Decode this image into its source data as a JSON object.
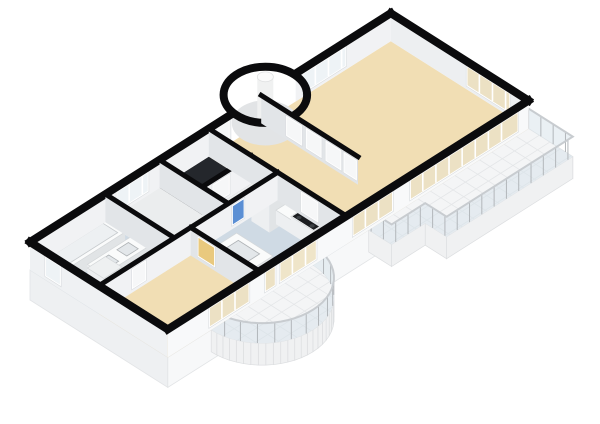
{
  "scene": {
    "canvas": {
      "width": 600,
      "height": 424,
      "background": "#ffffff"
    },
    "projection": {
      "ox": 30,
      "oy": 270,
      "k": 0.82,
      "m": 0.52
    },
    "wall_height": 28,
    "plinth_depth": 30,
    "railing_height": 20,
    "palette": {
      "wall_cut": "#0b0b0d",
      "face_se": "#f1f2f4",
      "face_sw": "#e2e5e8",
      "plinth_se": "#f7f8f9",
      "plinth_sw": "#eef0f2",
      "plinth_edge": "#e2e4e6",
      "terrace": "#f4f5f6",
      "terrace_line": "#e4e6e8",
      "slab": "#f0f1f2",
      "slab_edge": "#dcdee0",
      "railing_glass": "rgba(213,225,233,0.5)",
      "railing_post": "#b2b6ba",
      "railing_top": "#c8ccd0",
      "fix_top": "#fafbfb",
      "fix_se": "#e1e4e6",
      "fix_sw": "#edeff1",
      "turret_floor": "#e2e4e6",
      "column_body": "#f0f1f1",
      "column_top": "#fbfbfb",
      "stove_top": "#1b1d20",
      "burner": "#3c4044",
      "sink_fill": "#e3e7ea",
      "sink_edge": "#aeb2b5",
      "tub_inner": "#edf0f2",
      "tub_edge": "#c6cacd",
      "floors": {
        "wood": "#f1deb4",
        "tile": "#cfdae4",
        "plain": "#ebedee",
        "dark": "#24272c"
      },
      "features": {
        "window": "#eef3f6",
        "window-tan": "#efe5c9",
        "glass-tan": "#ece1c4",
        "door-white": "#f6f7f8",
        "door-blue": "#5b8fd4",
        "door-yellow": "#e9c97e"
      }
    },
    "plinth": [
      {
        "dir": "v",
        "x": 0,
        "y1": 0,
        "y2": 168
      },
      {
        "dir": "u",
        "y": 168,
        "x1": 0,
        "x2": 440
      }
    ],
    "terr": {
      "poly": [
        [
          245,
          168
        ],
        [
          440,
          168
        ],
        [
          440,
          222
        ],
        [
          286,
          222
        ],
        [
          286,
          196
        ],
        [
          245,
          196
        ]
      ],
      "railing": [
        [
          440,
          168
        ],
        [
          440,
          222
        ],
        [
          286,
          222
        ],
        [
          286,
          196
        ],
        [
          245,
          196
        ],
        [
          245,
          168
        ]
      ]
    },
    "balcony": {
      "center": [
        115,
        168
      ],
      "r": 62
    },
    "floors": [
      {
        "id": "floor-bathroom",
        "color": "tile",
        "rect": [
          0,
          0,
          92,
          84
        ]
      },
      {
        "id": "floor-room-left",
        "color": "plain",
        "rect": [
          92,
          0,
          158,
          84
        ]
      },
      {
        "id": "floor-closet-dark",
        "color": "dark",
        "rect": [
          158,
          0,
          218,
          52
        ]
      },
      {
        "id": "floor-room-mid",
        "color": "plain",
        "rect": [
          158,
          52,
          218,
          84
        ]
      },
      {
        "id": "floor-bedroom",
        "color": "wood",
        "rect": [
          0,
          84,
          112,
          168
        ]
      },
      {
        "id": "floor-kitchen",
        "color": "tile",
        "rect": [
          112,
          84,
          218,
          168
        ]
      },
      {
        "id": "floor-hall",
        "color": "wood",
        "rect": [
          218,
          0,
          286,
          168
        ]
      },
      {
        "id": "floor-living-room",
        "color": "wood",
        "rect": [
          282,
          0,
          440,
          168
        ]
      }
    ],
    "turret": {
      "center": [
        285,
        2
      ],
      "r_outer": 36,
      "r_inner": 29,
      "column": {
        "c": [
          285,
          2
        ],
        "r": 8,
        "h": 46
      }
    },
    "fixtures": [
      {
        "id": "bathtub",
        "type": "tub",
        "rect": [
          10,
          10,
          80,
          36
        ],
        "h": 15,
        "inner": [
          15,
          14,
          75,
          32
        ]
      },
      {
        "id": "vanity-double-sink",
        "type": "counter",
        "rect": [
          26,
          44,
          84,
          64
        ],
        "h": 15,
        "sinks": [
          [
            34,
            48,
            48,
            60
          ],
          [
            58,
            48,
            72,
            60
          ]
        ]
      },
      {
        "id": "bathroom-unit",
        "type": "unit",
        "rect": [
          8,
          62,
          30,
          82
        ],
        "h": 30
      },
      {
        "id": "kitchen-tall-cabinet",
        "type": "unit",
        "rect": [
          182,
          88,
          214,
          110
        ],
        "h": 30
      },
      {
        "id": "kitchen-counter",
        "type": "counter",
        "rect": [
          194,
          106,
          214,
          160
        ],
        "h": 14
      },
      {
        "id": "stove",
        "type": "stove",
        "rect": [
          196,
          122,
          212,
          150
        ],
        "h": 15,
        "burners": [
          [
            200,
            128
          ],
          [
            208,
            128
          ],
          [
            200,
            144
          ],
          [
            208,
            144
          ]
        ]
      },
      {
        "id": "kitchen-peninsula-sink",
        "type": "counter",
        "rect": [
          114,
          104,
          148,
          148
        ],
        "h": 14,
        "sinks": [
          [
            120,
            112,
            142,
            138
          ]
        ]
      },
      {
        "id": "floor-lamp",
        "type": "lamp",
        "pt": [
          331,
          150
        ],
        "r": 4
      }
    ],
    "walls_back": [
      {
        "id": "facade-nw-left",
        "dir": "u",
        "y": 0,
        "x1": 0,
        "x2": 246,
        "ext": true,
        "face": "#f1f2f4",
        "features": [
          {
            "type": "window",
            "a": 105,
            "b": 145
          },
          {
            "type": "door-white",
            "a": 228,
            "b": 244
          }
        ]
      },
      {
        "id": "facade-nw-right",
        "dir": "u",
        "y": 0,
        "x1": 324,
        "x2": 440,
        "ext": true,
        "face": "#f1f2f4",
        "features": [
          {
            "type": "window",
            "a": 332,
            "b": 386
          }
        ]
      },
      {
        "id": "facade-ne",
        "dir": "v",
        "x": 440,
        "y1": 0,
        "y2": 168,
        "ext": true,
        "face": "#edeff1",
        "features": [
          {
            "type": "glass-tan",
            "a": 92,
            "b": 146
          }
        ]
      }
    ],
    "walls_front": [
      {
        "id": "wall-closet",
        "dir": "u",
        "y": 52,
        "x1": 158,
        "x2": 218,
        "features": [
          {
            "type": "door-white",
            "a": 170,
            "b": 192
          }
        ]
      },
      {
        "id": "wall-bath-room",
        "dir": "v",
        "x": 92,
        "y1": 0,
        "y2": 84
      },
      {
        "id": "wall-room-closet",
        "dir": "v",
        "x": 158,
        "y1": 0,
        "y2": 84
      },
      {
        "id": "wall-hall-west",
        "dir": "v",
        "x": 218,
        "y1": 0,
        "y2": 168,
        "features": [
          {
            "type": "door-white",
            "a": 112,
            "b": 134
          }
        ]
      },
      {
        "id": "wall-hall-closets",
        "dir": "v",
        "x": 282,
        "y1": 0,
        "y2": 118,
        "features": [
          {
            "type": "door-white",
            "a": 30,
            "b": 50
          },
          {
            "type": "door-white",
            "a": 54,
            "b": 74
          },
          {
            "type": "door-white",
            "a": 78,
            "b": 98
          },
          {
            "type": "door-white",
            "a": 100,
            "b": 117
          }
        ]
      },
      {
        "id": "wall-middle",
        "dir": "u",
        "y": 84,
        "x1": 0,
        "x2": 218,
        "features": [
          {
            "type": "door-white",
            "a": 40,
            "b": 58
          },
          {
            "type": "door-blue",
            "a": 162,
            "b": 178
          }
        ]
      },
      {
        "id": "wall-bedroom-kitchen",
        "dir": "v",
        "x": 112,
        "y1": 84,
        "y2": 168,
        "features": [
          {
            "type": "door-yellow",
            "a": 92,
            "b": 114
          }
        ]
      },
      {
        "id": "facade-sw",
        "dir": "v",
        "x": 0,
        "y1": 0,
        "y2": 168,
        "ext": true,
        "face": "#eff1f3",
        "features": [
          {
            "type": "window",
            "a": 18,
            "b": 38
          }
        ]
      },
      {
        "id": "facade-se",
        "dir": "u",
        "y": 168,
        "x1": 0,
        "x2": 440,
        "ext": true,
        "face": "#f8f9fa",
        "features": [
          {
            "type": "glass-tan",
            "a": 50,
            "b": 100
          },
          {
            "type": "glass-tan",
            "a": 118,
            "b": 132
          },
          {
            "type": "window-tan",
            "a": 136,
            "b": 182
          },
          {
            "type": "glass-tan",
            "a": 225,
            "b": 275
          },
          {
            "type": "glass-tan",
            "a": 295,
            "b": 428
          }
        ]
      }
    ]
  }
}
